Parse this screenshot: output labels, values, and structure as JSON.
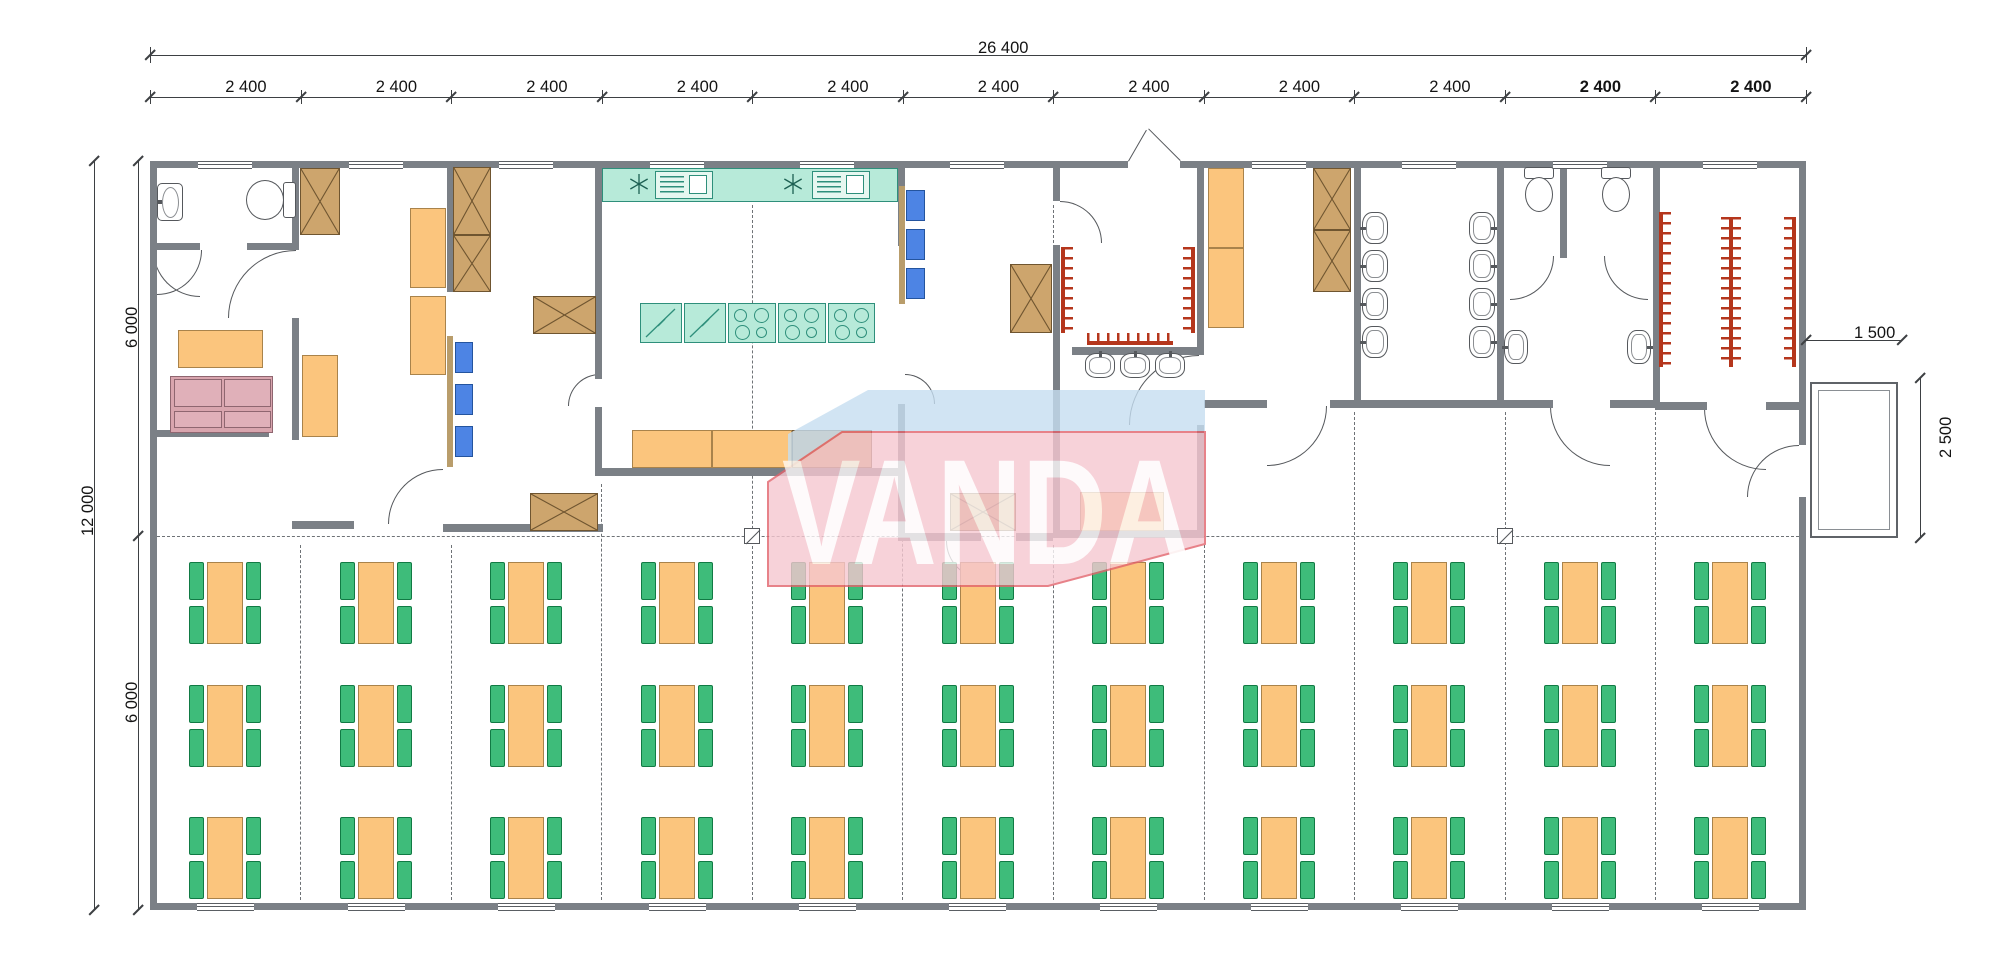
{
  "watermark": {
    "text": "VANDA",
    "pink": "#f6c7d0",
    "blue": "#c6def1",
    "edge": "#e2636c",
    "text_color": "#ffffff"
  },
  "dimensions": {
    "top_total": {
      "label": "26 400"
    },
    "top_modules": {
      "labels": [
        "2 400",
        "2 400",
        "2 400",
        "2 400",
        "2 400",
        "2 400",
        "2 400",
        "2 400",
        "2 400",
        "2 400",
        "2 400"
      ],
      "bold": [
        9,
        10
      ]
    },
    "left": {
      "total": "12 000",
      "upper": "6 000",
      "lower": "6 000"
    },
    "right": {
      "porch_width": "1 500",
      "porch_depth": "2 500"
    }
  },
  "colors": {
    "wall": "#7b8086",
    "dim": "#3d4043",
    "orange": "#fbc57d",
    "orange_border": "#a9834b",
    "tan": "#cda56d",
    "tan_border": "#6f5530",
    "teal": "#b7ead9",
    "teal_border": "#2e8f7b",
    "blue": "#4d84e4",
    "blue_border": "#24549e",
    "green": "#3ebc7a",
    "green_border": "#117a44",
    "pink": "#d9a5ae",
    "pink_border": "#8f6670",
    "red": "#b5361c",
    "fixture": "#55585c"
  },
  "plan": {
    "width": 2000,
    "height": 975,
    "walls": [
      [
        150,
        161,
        978,
        7
      ],
      [
        1180,
        161,
        626,
        7
      ],
      [
        150,
        903,
        1656,
        7
      ],
      [
        150,
        161,
        7,
        749
      ],
      [
        1799,
        161,
        7,
        284
      ],
      [
        1799,
        497,
        7,
        413
      ],
      [
        292,
        161,
        7,
        89
      ],
      [
        150,
        243,
        50,
        7
      ],
      [
        247,
        243,
        52,
        7
      ],
      [
        150,
        430,
        119,
        7
      ],
      [
        292,
        318,
        7,
        122
      ],
      [
        292,
        521,
        62,
        8
      ],
      [
        443,
        524,
        160,
        8
      ],
      [
        447,
        161,
        7,
        131
      ],
      [
        595,
        161,
        7,
        218
      ],
      [
        595,
        407,
        7,
        69
      ],
      [
        595,
        468,
        310,
        8
      ],
      [
        898,
        161,
        7,
        85
      ],
      [
        898,
        404,
        7,
        137
      ],
      [
        898,
        533,
        83,
        8
      ],
      [
        1016,
        533,
        37,
        8
      ],
      [
        1053,
        161,
        7,
        40
      ],
      [
        1053,
        245,
        7,
        292
      ],
      [
        1072,
        347,
        125,
        8
      ],
      [
        1053,
        530,
        144,
        8
      ],
      [
        1197,
        161,
        7,
        194
      ],
      [
        1197,
        425,
        7,
        113
      ],
      [
        1204,
        400,
        63,
        8
      ],
      [
        1330,
        400,
        223,
        8
      ],
      [
        1610,
        400,
        45,
        8
      ],
      [
        1354,
        161,
        7,
        247
      ],
      [
        1497,
        161,
        7,
        247
      ],
      [
        1560,
        161,
        7,
        97
      ],
      [
        1653,
        161,
        7,
        247
      ],
      [
        1655,
        402,
        52,
        8
      ],
      [
        1766,
        402,
        33,
        8
      ]
    ],
    "windows_top": [
      225,
      376,
      526,
      677,
      827,
      977,
      1279,
      1429,
      1580,
      1730
    ],
    "windows_bottom": [
      225,
      376,
      526,
      677,
      827,
      977,
      1128,
      1279,
      1429,
      1580,
      1730
    ],
    "grid_v": [
      [
        300,
        545,
        900
      ],
      [
        451,
        545,
        900
      ],
      [
        601,
        484,
        900
      ],
      [
        752,
        205,
        900
      ],
      [
        902,
        484,
        900
      ],
      [
        1053,
        205,
        243
      ],
      [
        1053,
        545,
        900
      ],
      [
        1204,
        545,
        900
      ],
      [
        1354,
        412,
        900
      ],
      [
        1505,
        412,
        900
      ],
      [
        1655,
        412,
        900
      ]
    ],
    "grid_h": [
      [
        536,
        157,
        1799
      ]
    ],
    "markers": [
      [
        752,
        536
      ],
      [
        1505,
        536
      ]
    ],
    "arcs": [
      [
        153,
        250,
        47,
        "bl"
      ],
      [
        228,
        250,
        68,
        "tl"
      ],
      [
        157,
        250,
        45,
        "br"
      ],
      [
        388,
        469,
        55,
        "tl"
      ],
      [
        568,
        374,
        32,
        "tl"
      ],
      [
        905,
        374,
        30,
        "tr"
      ],
      [
        946,
        541,
        38,
        "bl"
      ],
      [
        1060,
        201,
        42,
        "tr"
      ],
      [
        1129,
        355,
        70,
        "tl"
      ],
      [
        1267,
        406,
        60,
        "br"
      ],
      [
        1550,
        406,
        60,
        "bl"
      ],
      [
        1510,
        256,
        44,
        "br"
      ],
      [
        1604,
        256,
        44,
        "bl"
      ],
      [
        1704,
        408,
        62,
        "bl"
      ],
      [
        1747,
        445,
        52,
        "tl"
      ]
    ],
    "lines": [
      [
        1128,
        161,
        36,
        -60
      ],
      [
        1180,
        161,
        45,
        -135
      ]
    ],
    "porch": {
      "outer": [
        1810,
        382,
        88,
        156
      ],
      "inner": [
        1818,
        390,
        72,
        140
      ]
    },
    "furniture": [
      {
        "kind": "sink",
        "rect": [
          157,
          183,
          26,
          38
        ],
        "orient": "left"
      },
      {
        "kind": "toilet",
        "rect": [
          246,
          180,
          50,
          40
        ],
        "orient": "right"
      },
      {
        "kind": "orange",
        "rect": [
          178,
          330,
          85,
          38
        ]
      },
      {
        "kind": "sofa",
        "rect": [
          170,
          376,
          103,
          57
        ]
      },
      {
        "kind": "xcab",
        "rect": [
          300,
          168,
          40,
          67
        ]
      },
      {
        "kind": "orange",
        "rect": [
          410,
          208,
          36,
          80
        ]
      },
      {
        "kind": "orange",
        "rect": [
          410,
          296,
          36,
          79
        ]
      },
      {
        "kind": "orange",
        "rect": [
          302,
          355,
          36,
          82
        ]
      },
      {
        "kind": "xcab",
        "rect": [
          453,
          167,
          38,
          68
        ]
      },
      {
        "kind": "xcab",
        "rect": [
          453,
          235,
          38,
          57
        ]
      },
      {
        "kind": "xcab",
        "rect": [
          533,
          296,
          63,
          38
        ]
      },
      {
        "kind": "xcab",
        "rect": [
          530,
          493,
          68,
          38
        ]
      },
      {
        "kind": "strip",
        "rect": [
          447,
          336,
          6,
          131
        ]
      },
      {
        "kind": "bluebox",
        "rect": [
          455,
          342,
          18,
          31
        ]
      },
      {
        "kind": "bluebox",
        "rect": [
          455,
          384,
          18,
          31
        ]
      },
      {
        "kind": "bluebox",
        "rect": [
          455,
          426,
          18,
          31
        ]
      },
      {
        "kind": "counter",
        "rect": [
          602,
          168,
          296,
          34
        ]
      },
      {
        "kind": "asterisk",
        "rect": [
          629,
          174,
          20,
          20
        ]
      },
      {
        "kind": "sinkunit",
        "rect": [
          655,
          171,
          58,
          28
        ]
      },
      {
        "kind": "asterisk",
        "rect": [
          783,
          174,
          20,
          20
        ]
      },
      {
        "kind": "sinkunit",
        "rect": [
          812,
          171,
          58,
          28
        ]
      },
      {
        "kind": "fridge",
        "rect": [
          640,
          303,
          42,
          40
        ]
      },
      {
        "kind": "fridge",
        "rect": [
          684,
          303,
          42,
          40
        ]
      },
      {
        "kind": "stove",
        "rect": [
          728,
          303,
          48,
          40
        ]
      },
      {
        "kind": "stove",
        "rect": [
          778,
          303,
          48,
          40
        ]
      },
      {
        "kind": "stove",
        "rect": [
          828,
          303,
          47,
          40
        ]
      },
      {
        "kind": "orange",
        "rect": [
          632,
          430,
          80,
          38
        ]
      },
      {
        "kind": "orange",
        "rect": [
          712,
          430,
          80,
          38
        ]
      },
      {
        "kind": "tan",
        "rect": [
          792,
          430,
          80,
          38
        ]
      },
      {
        "kind": "strip",
        "rect": [
          899,
          186,
          6,
          118
        ]
      },
      {
        "kind": "bluebox",
        "rect": [
          906,
          190,
          19,
          31
        ]
      },
      {
        "kind": "bluebox",
        "rect": [
          906,
          229,
          19,
          31
        ]
      },
      {
        "kind": "bluebox",
        "rect": [
          906,
          268,
          19,
          31
        ]
      },
      {
        "kind": "xcab",
        "rect": [
          950,
          493,
          66,
          38
        ]
      },
      {
        "kind": "xcab",
        "rect": [
          1010,
          264,
          42,
          69
        ]
      },
      {
        "kind": "rack",
        "rect": [
          1061,
          247,
          4,
          86
        ],
        "orient": "right"
      },
      {
        "kind": "rack",
        "rect": [
          1191,
          247,
          4,
          86
        ],
        "orient": "left"
      },
      {
        "kind": "rack",
        "rect": [
          1087,
          341,
          86,
          4
        ],
        "orient": "top"
      },
      {
        "kind": "basin",
        "rect": [
          1085,
          353,
          30,
          25
        ],
        "orient": "top"
      },
      {
        "kind": "basin",
        "rect": [
          1120,
          353,
          30,
          25
        ],
        "orient": "top"
      },
      {
        "kind": "basin",
        "rect": [
          1155,
          353,
          30,
          25
        ],
        "orient": "top"
      },
      {
        "kind": "orange",
        "rect": [
          1080,
          492,
          84,
          39
        ]
      },
      {
        "kind": "locker",
        "rect": [
          1208,
          168,
          36,
          80
        ]
      },
      {
        "kind": "locker",
        "rect": [
          1208,
          248,
          36,
          80
        ]
      },
      {
        "kind": "xcab",
        "rect": [
          1313,
          168,
          38,
          62
        ]
      },
      {
        "kind": "xcab",
        "rect": [
          1313,
          230,
          38,
          62
        ]
      },
      {
        "kind": "basin",
        "rect": [
          1362,
          212,
          26,
          32
        ],
        "orient": "left"
      },
      {
        "kind": "basin",
        "rect": [
          1362,
          250,
          26,
          32
        ],
        "orient": "left"
      },
      {
        "kind": "basin",
        "rect": [
          1362,
          288,
          26,
          32
        ],
        "orient": "left"
      },
      {
        "kind": "basin",
        "rect": [
          1362,
          326,
          26,
          32
        ],
        "orient": "left"
      },
      {
        "kind": "basin",
        "rect": [
          1469,
          212,
          26,
          32
        ],
        "orient": "right"
      },
      {
        "kind": "basin",
        "rect": [
          1469,
          250,
          26,
          32
        ],
        "orient": "right"
      },
      {
        "kind": "basin",
        "rect": [
          1469,
          288,
          26,
          32
        ],
        "orient": "right"
      },
      {
        "kind": "basin",
        "rect": [
          1469,
          326,
          26,
          32
        ],
        "orient": "right"
      },
      {
        "kind": "toilet",
        "rect": [
          1521,
          167,
          36,
          46
        ],
        "orient": "up"
      },
      {
        "kind": "toilet",
        "rect": [
          1598,
          167,
          36,
          46
        ],
        "orient": "up"
      },
      {
        "kind": "basin",
        "rect": [
          1504,
          330,
          24,
          34
        ],
        "orient": "left"
      },
      {
        "kind": "basin",
        "rect": [
          1627,
          330,
          24,
          34
        ],
        "orient": "right"
      },
      {
        "kind": "rack",
        "rect": [
          1659,
          212,
          4,
          155
        ],
        "orient": "right"
      },
      {
        "kind": "rack",
        "rect": [
          1729,
          217,
          4,
          150
        ],
        "orient": "both"
      },
      {
        "kind": "rack",
        "rect": [
          1792,
          217,
          4,
          150
        ],
        "orient": "left"
      }
    ],
    "dining": {
      "cols": [
        225,
        376,
        526,
        677,
        827,
        978,
        1128,
        1279,
        1429,
        1580,
        1730
      ],
      "rows": [
        603,
        726,
        858
      ],
      "table": [
        36,
        82
      ],
      "chair": [
        15,
        38
      ]
    },
    "dims": {
      "top1": {
        "y": 55,
        "x1": 150,
        "x2": 1806,
        "label_xy": [
          978,
          39
        ]
      },
      "top2": {
        "y": 97,
        "bounds": [
          150,
          300.5,
          451,
          601.5,
          752,
          902.5,
          1053,
          1203.5,
          1354,
          1504.5,
          1655,
          1805.5
        ],
        "label_y": 78
      },
      "leftA": {
        "x": 94,
        "y1": 161,
        "y2": 910,
        "label_xy": [
          79,
          536
        ]
      },
      "leftB": {
        "x": 138,
        "y1": 161,
        "y2": 910,
        "mid": 536,
        "labels_xy": [
          [
            123,
            348
          ],
          [
            123,
            723
          ]
        ]
      },
      "rightA": {
        "y": 340,
        "x1": 1806,
        "x2": 1902,
        "label_xy": [
          1854,
          324
        ]
      },
      "rightB": {
        "x": 1920,
        "y1": 378,
        "y2": 538,
        "label_xy": [
          1937,
          458
        ]
      }
    },
    "watermark_box": [
      768,
      386,
      437,
      204
    ]
  }
}
